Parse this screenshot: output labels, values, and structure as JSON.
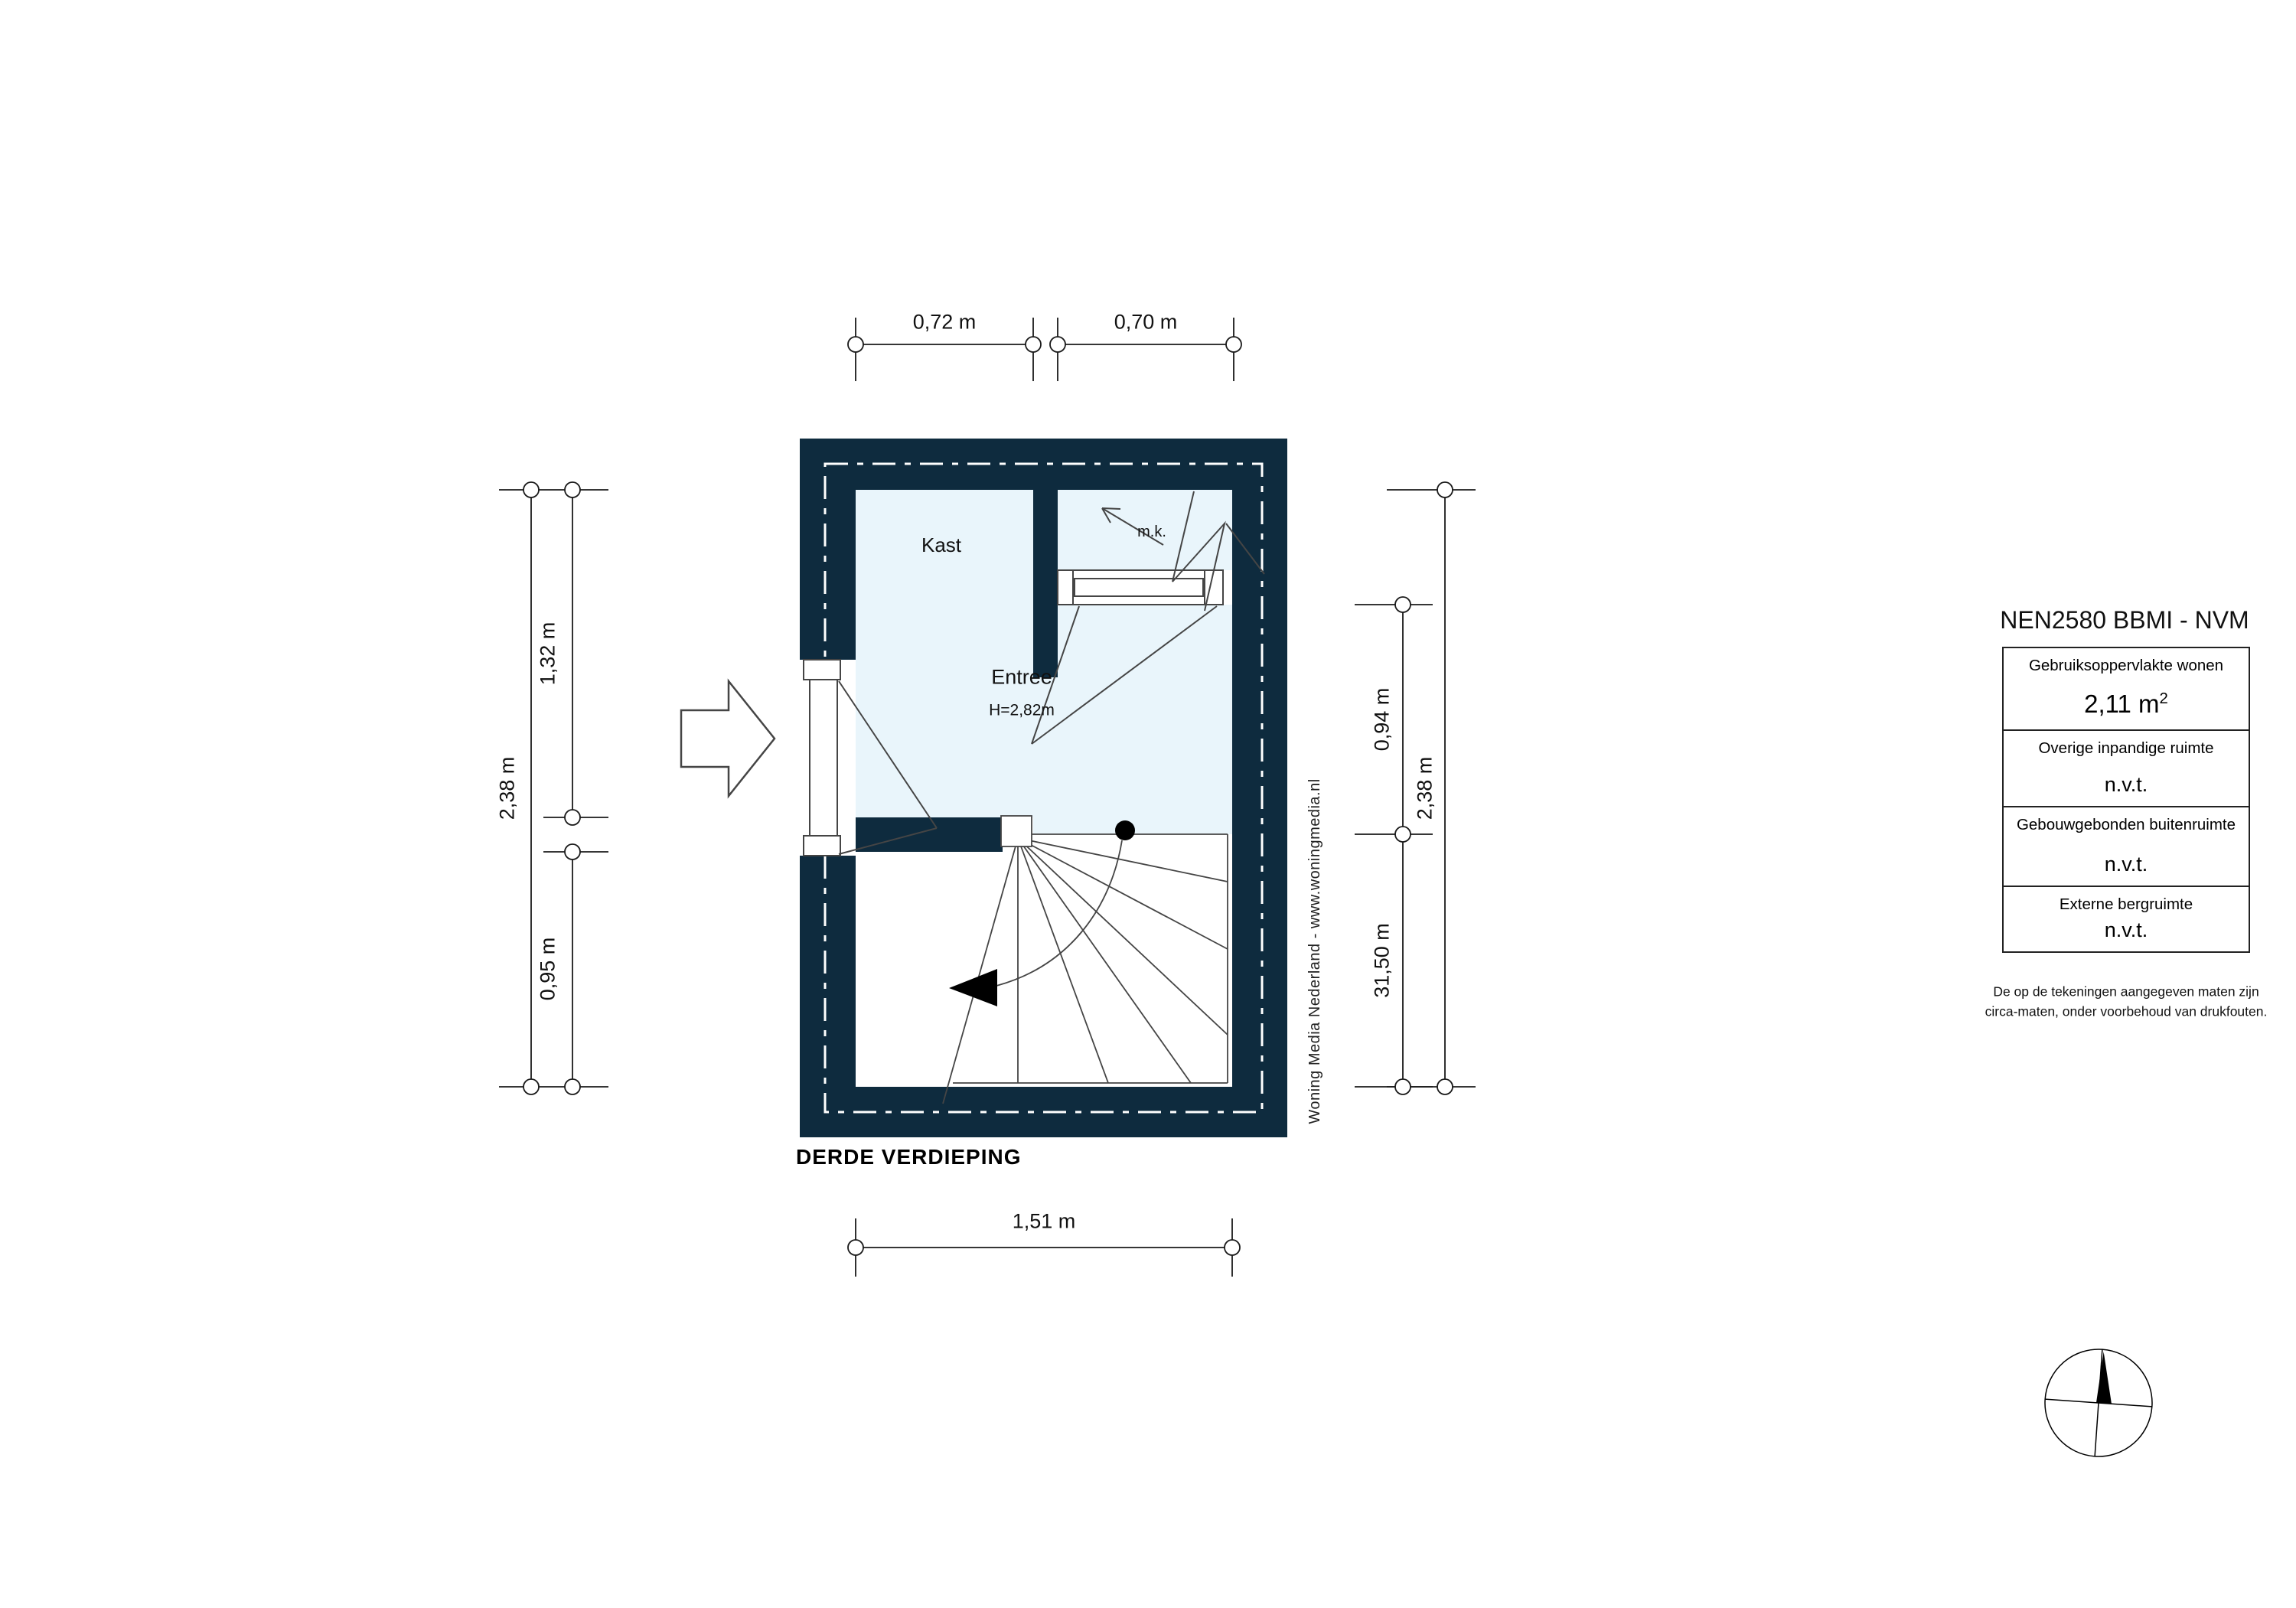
{
  "plan": {
    "floor_label": "DERDE VERDIEPING",
    "kast_label": "Kast",
    "mk_label": "m.k.",
    "entree_label": "Entree",
    "entree_height_label": "H=2,82m"
  },
  "dimensions": {
    "top": [
      "0,72 m",
      "0,70 m"
    ],
    "left_inner_top": "1,32 m",
    "left_outer": "2,38 m",
    "left_inner_bottom": "0,95 m",
    "right_inner_top": "0,94 m",
    "right_outer": "2,38 m",
    "right_inner_bottom": "31,50 m",
    "bottom": "1,51 m"
  },
  "legend": {
    "title": "NEN2580 BBMI - NVM",
    "rows": [
      {
        "label": "Gebruiksoppervlakte wonen",
        "value": "2,11 m",
        "sup": "2"
      },
      {
        "label": "Overige inpandige ruimte",
        "value": "n.v.t.",
        "sup": ""
      },
      {
        "label": "Gebouwgebonden buitenruimte",
        "value": "n.v.t.",
        "sup": ""
      },
      {
        "label": "Externe bergruimte",
        "value": "n.v.t.",
        "sup": ""
      }
    ],
    "note_line1": "De op de tekeningen aangegeven maten zijn",
    "note_line2": "circa-maten, onder voorbehoud van drukfouten."
  },
  "branding": "Woning Media Nederland - www.woningmedia.nl",
  "colors": {
    "wall": "#0e2b3e",
    "room_fill": "#e9f5fb",
    "detail_line": "#454545",
    "dim_line": "#1a1a1a"
  }
}
